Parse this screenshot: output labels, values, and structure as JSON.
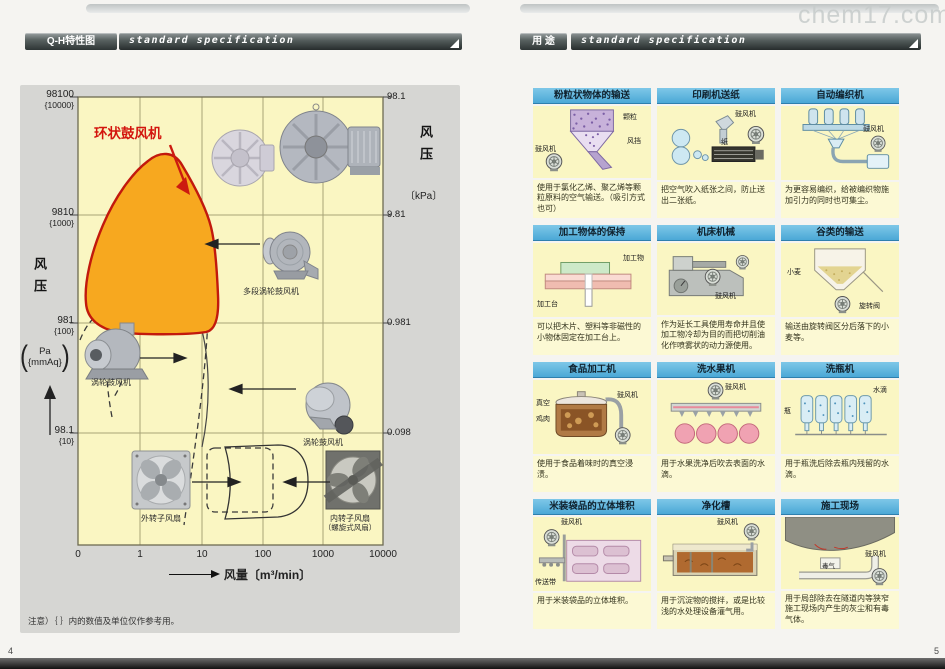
{
  "watermark": "chem17.com",
  "page_left": {
    "tab": "Q-H特性图",
    "header_title": "standard specification",
    "page_number": "4",
    "note": "注意）｛ ｝内的数值及单位仅作参考用。",
    "chart": {
      "highlight_label": "环状鼓风机",
      "y_axis_left": {
        "title": "风压",
        "unit_open": "(",
        "unit_line1": "Pa",
        "unit_line2": "{mmAq}",
        "unit_close": ")",
        "ticks": [
          {
            "value": "98100",
            "ref": "{10000}"
          },
          {
            "value": "9810",
            "ref": "{1000}"
          },
          {
            "value": "981",
            "ref": "{100}"
          },
          {
            "value": "98.1",
            "ref": "{10}"
          }
        ]
      },
      "y_axis_right": {
        "title": "风压",
        "unit": "〔kPa〕",
        "ticks": [
          "98.1",
          "9.81",
          "0.981",
          "0.098"
        ]
      },
      "x_axis": {
        "title": "风量〔m³/min〕",
        "ticks": [
          "0",
          "1",
          "10",
          "100",
          "1000",
          "10000"
        ]
      },
      "machine_labels": {
        "multistage_turbo": "多段涡轮鼓风机",
        "turbo_left": "涡轮鼓风机",
        "turbo_right": "涡轮鼓风机",
        "fan_outer": "外转子风扇",
        "fan_inner_line1": "内转子风扇",
        "fan_inner_line2": "（螺旋式风扇）"
      }
    }
  },
  "page_right": {
    "tab": "用 途",
    "header_title": "standard specification",
    "page_number": "5",
    "cells": [
      {
        "title": "粉粒状物体的输送",
        "caption": "使用于氯化乙烯、聚乙烯等颗粒原料的空气输送。（吸引方式也可）",
        "annotations": [
          "鼓风机",
          "颗粒",
          "风挡"
        ]
      },
      {
        "title": "印刷机送纸",
        "caption": "把空气吹入纸张之间，防止送出二张纸。",
        "annotations": [
          "鼓风机",
          "纸"
        ]
      },
      {
        "title": "自动编织机",
        "caption": "为更容易编织，给被编织物施加引力的同时也可集尘。",
        "annotations": [
          "鼓风机"
        ]
      },
      {
        "title": "加工物体的保持",
        "caption": "可以把木片、塑料等非磁性的小物体固定在加工台上。",
        "annotations": [
          "加工物",
          "加工台"
        ]
      },
      {
        "title": "机床机械",
        "caption": "作为延长工具使用寿命并且使加工物冷却为目的而把切削油化作喷雾状的动力源使用。",
        "annotations": [
          "鼓风机"
        ]
      },
      {
        "title": "谷类的输送",
        "caption": "输送由旋转阀区分后落下的小麦等。",
        "annotations": [
          "小麦",
          "旋转阀"
        ]
      },
      {
        "title": "食品加工机",
        "caption": "使用于食品着味时的真空浸渍。",
        "annotations": [
          "真空",
          "鸡肉",
          "鼓风机"
        ]
      },
      {
        "title": "洗水果机",
        "caption": "用于水果洗净后吹去表面的水滴。",
        "annotations": [
          "鼓风机"
        ]
      },
      {
        "title": "洗瓶机",
        "caption": "用于瓶洗后除去瓶内残留的水滴。",
        "annotations": [
          "瓶",
          "水滴"
        ]
      },
      {
        "title": "米装袋品的立体堆积",
        "caption": "用于米装袋品的立体堆积。",
        "annotations": [
          "鼓风机",
          "传送带"
        ]
      },
      {
        "title": "净化槽",
        "caption": "用于沉淀物的搅拌，或是比较浅的水处理设备灌气用。",
        "annotations": [
          "鼓风机"
        ]
      },
      {
        "title": "施工现场",
        "caption": "用于局部除去在隧道内等狭窄施工现场内产生的灰尘和有毒气体。",
        "annotations": [
          "鼓风机",
          "毒气"
        ]
      }
    ]
  },
  "chart_data": {
    "type": "region-map",
    "title": "Q-H特性图",
    "xlabel": "风量〔m³/min〕",
    "x_scale": "log",
    "x_ticks": [
      0,
      1,
      10,
      100,
      1000,
      10000
    ],
    "ylabel_left": "风压 Pa｛mmAq｝",
    "ylabel_right": "风压〔kPa〕",
    "y_ticks_left_pa": [
      98100,
      9810,
      981,
      98.1
    ],
    "y_ticks_left_mmaq": [
      10000,
      1000,
      100,
      10
    ],
    "y_ticks_right_kpa": [
      98.1,
      9.81,
      0.981,
      0.098
    ],
    "regions": [
      {
        "name": "环状鼓风机",
        "style": "orange-highlight",
        "flow_m3min_approx": [
          0.3,
          30
        ],
        "pressure_kpa_approx": [
          1,
          50
        ]
      },
      {
        "name": "多段涡轮鼓风机",
        "style": "dashed",
        "flow_m3min_approx": [
          0.5,
          60
        ],
        "pressure_kpa_approx": [
          0.3,
          20
        ]
      },
      {
        "name": "涡轮鼓风机",
        "style": "dashed",
        "flow_m3min_approx": [
          1,
          300
        ],
        "pressure_kpa_approx": [
          0.1,
          3
        ]
      },
      {
        "name": "外转子风扇",
        "style": "solid",
        "flow_m3min_approx": [
          10,
          500
        ],
        "pressure_kpa_approx": [
          0.02,
          0.3
        ]
      },
      {
        "name": "内转子风扇（螺旋式风扇）",
        "style": "dashed",
        "flow_m3min_approx": [
          20,
          1000
        ],
        "pressure_kpa_approx": [
          0.02,
          0.3
        ]
      }
    ],
    "grid": true,
    "note": "注意）｛ ｝内的数值及单位仅作参考用。"
  }
}
